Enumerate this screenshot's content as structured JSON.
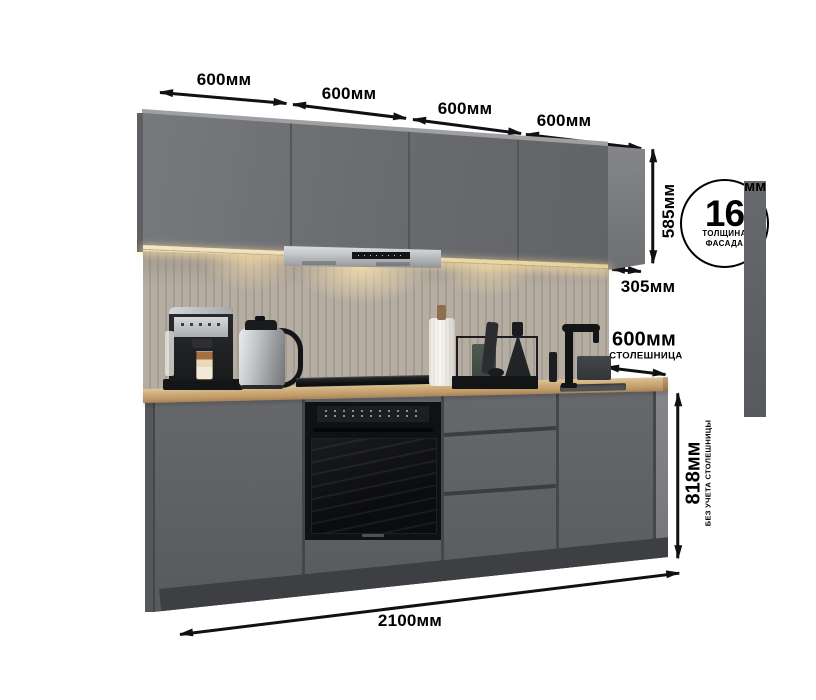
{
  "dimensions": {
    "top_widths": [
      "600мм",
      "600мм",
      "600мм",
      "600мм"
    ],
    "upper_cabinet_height": "585мм",
    "upper_cabinet_depth": "305мм",
    "countertop_depth": "600мм",
    "countertop_caption": "СТОЛЕШНИЦА",
    "base_height": "818мм",
    "base_height_caption": "БЕЗ УЧЕТА СТОЛЕШНИЦЫ",
    "total_width": "2100мм"
  },
  "facade_badge": {
    "value": "16",
    "unit": "мм",
    "caption_line1": "ТОЛЩИНА",
    "caption_line2": "ФАСАДА"
  },
  "scene": {
    "items": [
      "upper-cabinets",
      "range-hood",
      "led-strip",
      "backsplash-panel",
      "coffee-machine",
      "electric-kettle",
      "induction-hob",
      "paper-towel-roll",
      "cutting-board-rack",
      "oil-bottle",
      "black-faucet",
      "sink",
      "wood-countertop",
      "base-cabinets",
      "built-in-oven",
      "drawer-unit",
      "plinth"
    ]
  },
  "colors": {
    "background": "#ffffff",
    "dimension_line": "#111111",
    "upper_cabinet": "#6c6e71",
    "base_cabinet": "#5e6064",
    "plinth": "#3d3f42",
    "countertop": "#c9a674",
    "backsplash": "#b2a99e",
    "hood_steel": "#c6c9cb",
    "led_glow": "#eed9a0",
    "appliance_black": "#131416"
  }
}
